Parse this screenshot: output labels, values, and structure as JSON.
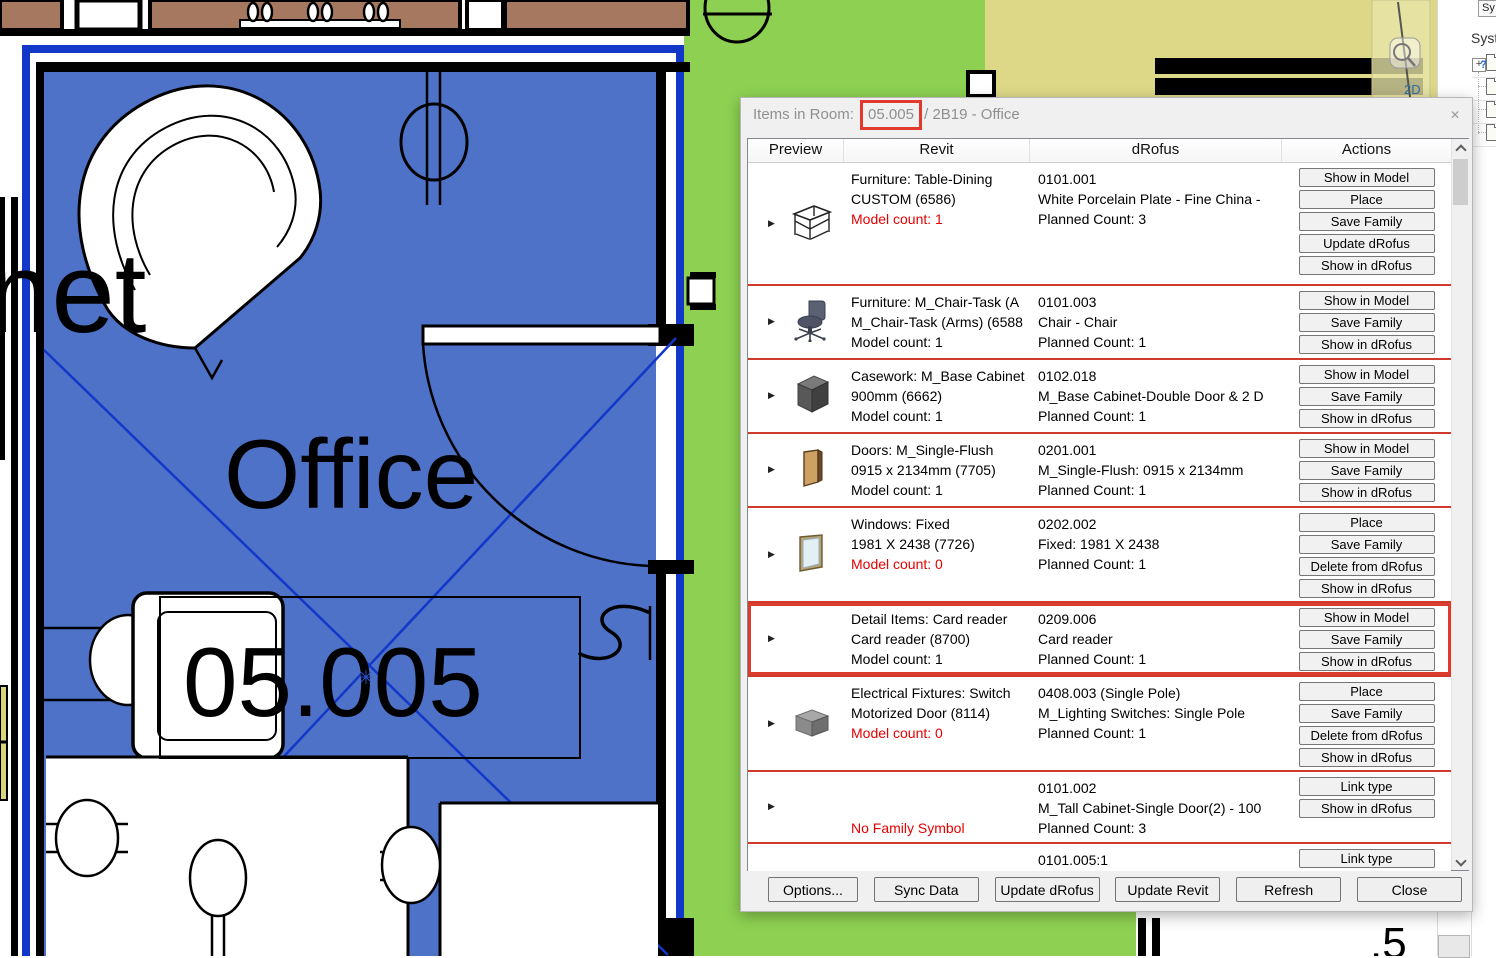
{
  "plan": {
    "room_name": "Office",
    "room_number": "05.005",
    "adjacent_text_partial": "net",
    "corner_number_partial": ".5",
    "asterisk_glyph": "✳",
    "colors": {
      "room_fill": "#4d72c8",
      "selection_blue": "#1237c9",
      "green_area": "#8ed152",
      "khaki_area": "#ddd887",
      "casework_brown": "#a5785f"
    }
  },
  "navigation_bar": {
    "zoom_2d_label": "2D"
  },
  "system_browser": {
    "collapsed_button_label": "Sy",
    "panel_title_partial": "Syste",
    "expander_glyph": "+",
    "unknown_glyph": "?"
  },
  "dialog": {
    "title_prefix": "Items in Room:",
    "highlighted_room_number": "05.005",
    "title_suffix": "/ 2B19 - Office",
    "close_glyph": "✕",
    "expand_glyph": "▶",
    "columns": [
      "Preview",
      "Revit",
      "dRofus",
      "Actions"
    ],
    "accent": {
      "highlight_red": "#da3c2e",
      "separator_red": "#cf3a2b",
      "alert_text_red": "#e60000"
    },
    "rows": [
      {
        "icon": "table",
        "revit": [
          {
            "t": "Furniture: Table-Dining"
          },
          {
            "t": "CUSTOM (6586)"
          },
          {
            "t": "Model count: 1",
            "red": true
          }
        ],
        "drofus": [
          "0101.001",
          "White Porcelain Plate - Fine China -",
          "Planned Count: 3"
        ],
        "actions": [
          "Show in Model",
          "Place",
          "Save Family",
          "Update dRofus",
          "Show in dRofus"
        ],
        "highlight": false
      },
      {
        "icon": "chair",
        "revit": [
          {
            "t": "Furniture: M_Chair-Task (A"
          },
          {
            "t": "M_Chair-Task (Arms) (6588"
          },
          {
            "t": "Model count: 1"
          }
        ],
        "drofus": [
          "0101.003",
          "Chair - Chair",
          "Planned Count: 1"
        ],
        "actions": [
          "Show in Model",
          "Save Family",
          "Show in dRofus"
        ],
        "highlight": false
      },
      {
        "icon": "cabinet",
        "revit": [
          {
            "t": "Casework: M_Base Cabinet"
          },
          {
            "t": "900mm (6662)"
          },
          {
            "t": "Model count: 1"
          }
        ],
        "drofus": [
          "0102.018",
          "M_Base Cabinet-Double Door & 2 D",
          "Planned Count: 1"
        ],
        "actions": [
          "Show in Model",
          "Save Family",
          "Show in dRofus"
        ],
        "highlight": false
      },
      {
        "icon": "door",
        "revit": [
          {
            "t": "Doors: M_Single-Flush"
          },
          {
            "t": "0915 x 2134mm (7705)"
          },
          {
            "t": "Model count: 1"
          }
        ],
        "drofus": [
          "0201.001",
          "M_Single-Flush: 0915 x 2134mm",
          "Planned Count: 1"
        ],
        "actions": [
          "Show in Model",
          "Save Family",
          "Show in dRofus"
        ],
        "highlight": false
      },
      {
        "icon": "window",
        "revit": [
          {
            "t": "Windows: Fixed"
          },
          {
            "t": "1981 X 2438 (7726)"
          },
          {
            "t": "Model count: 0",
            "red": true
          }
        ],
        "drofus": [
          "0202.002",
          "Fixed: 1981 X 2438",
          "Planned Count: 1"
        ],
        "actions": [
          "Place",
          "Save Family",
          "Delete from dRofus",
          "Show in dRofus"
        ],
        "highlight": false
      },
      {
        "icon": null,
        "revit": [
          {
            "t": "Detail Items: Card reader"
          },
          {
            "t": "Card reader (8700)"
          },
          {
            "t": "Model count: 1"
          }
        ],
        "drofus": [
          "0209.006",
          "Card reader",
          "Planned Count: 1"
        ],
        "actions": [
          "Show in Model",
          "Save Family",
          "Show in dRofus"
        ],
        "highlight": true
      },
      {
        "icon": "switch",
        "revit": [
          {
            "t": "Electrical Fixtures: Switch"
          },
          {
            "t": "Motorized Door (8114)"
          },
          {
            "t": "Model count: 0",
            "red": true
          }
        ],
        "drofus": [
          "0408.003 (Single Pole)",
          "M_Lighting Switches: Single Pole",
          "Planned Count: 1"
        ],
        "actions": [
          "Place",
          "Save Family",
          "Delete from dRofus",
          "Show in dRofus"
        ],
        "highlight": false
      },
      {
        "icon": null,
        "revit": [
          {
            "t": ""
          },
          {
            "t": ""
          },
          {
            "t": "No Family Symbol",
            "red": true
          }
        ],
        "drofus": [
          "0101.002",
          "M_Tall Cabinet-Single Door(2) - 100",
          "Planned Count: 3"
        ],
        "actions": [
          "Link type",
          "Show in dRofus"
        ],
        "highlight": false
      },
      {
        "icon": null,
        "revit": [
          {
            "t": ""
          },
          {
            "t": ""
          }
        ],
        "drofus": [
          "0101.005:1",
          "Armchair With armrest"
        ],
        "actions": [
          "Link type",
          "Delete from dRofus"
        ],
        "highlight": false
      }
    ],
    "footer_buttons": [
      "Options...",
      "Sync Data",
      "Update dRofus",
      "Update Revit",
      "Refresh",
      "Close"
    ]
  }
}
